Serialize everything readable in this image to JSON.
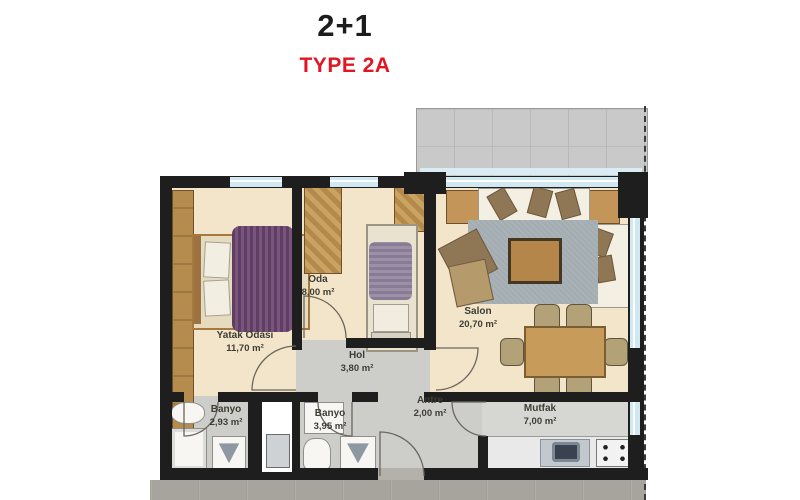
{
  "header": {
    "title": "2+1",
    "subtitle": "TYPE 2A"
  },
  "rooms": {
    "yatak_odasi": {
      "name": "Yatak Odası",
      "area": "11,70 m²"
    },
    "oda": {
      "name": "Oda",
      "area": "8,00 m²"
    },
    "salon": {
      "name": "Salon",
      "area": "20,70 m²"
    },
    "hol": {
      "name": "Hol",
      "area": "3,80 m²"
    },
    "antre": {
      "name": "Antre",
      "area": "2,00 m²"
    },
    "banyo_small": {
      "name": "Banyo",
      "area": "2,93 m²"
    },
    "banyo_large": {
      "name": "Banyo",
      "area": "3,95 m²"
    },
    "mutfak": {
      "name": "Mutfak",
      "area": "7,00 m²"
    }
  },
  "colors": {
    "title_black": "#1c1c1c",
    "type_red": "#e11622",
    "wall": "#1e1e1e",
    "floor_cream": "#f2e5ca",
    "floor_gray": "#cdcdca",
    "corridor_gray": "#a7a39d",
    "balcony_gray": "#c9c9c9",
    "window_blue": "#cfe8f2",
    "wood": "#c39558",
    "bed_purple": "#6d4a70",
    "rug_gray": "#a2acb1",
    "label_text": "#3e3d34"
  }
}
